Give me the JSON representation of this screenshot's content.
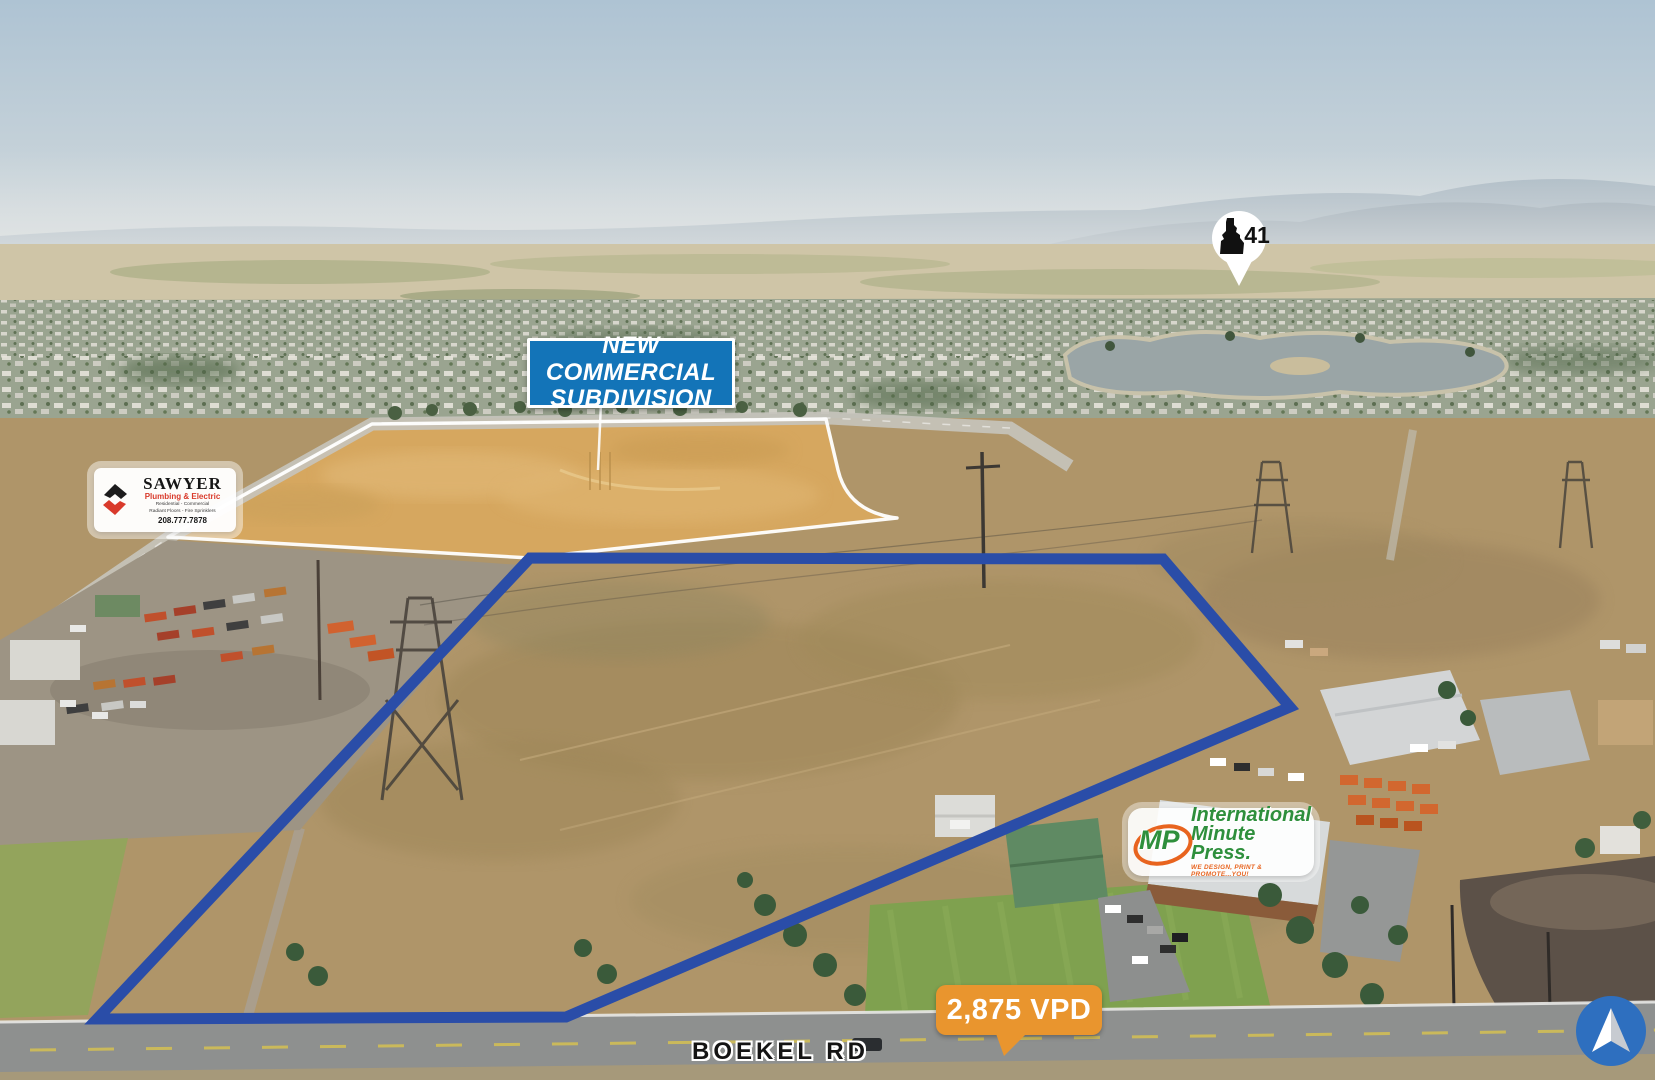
{
  "annotations": {
    "subdivision_sign": {
      "line1": "NEW COMMERCIAL",
      "line2": "SUBDIVISION",
      "bg_color": "#1374b8"
    },
    "highway_marker": {
      "route": "41"
    },
    "sawyer_badge": {
      "name": "SAWYER",
      "tagline": "Plumbing & Electric",
      "services_line1": "Residential - Commercial",
      "services_line2": "Radiant Floors - Fire Sprinklers",
      "phone": "208.777.7878",
      "accent_color": "#d93a2b"
    },
    "minute_press_badge": {
      "monogram": "MP",
      "line1": "International",
      "line2": "Minute Press.",
      "tagline": "WE DESIGN, PRINT & PROMOTE...YOU!",
      "green": "#2e8f3c",
      "orange": "#e8641f"
    },
    "traffic_badge": {
      "label": "2,875 VPD",
      "color": "#e9952e"
    },
    "road_label": {
      "text": "BOEKEL RD"
    },
    "property_boundary": {
      "color": "#2a4da8"
    },
    "subdivision_boundary": {
      "color": "#ffffff"
    },
    "compass": {
      "color": "#2e6fbf"
    }
  }
}
